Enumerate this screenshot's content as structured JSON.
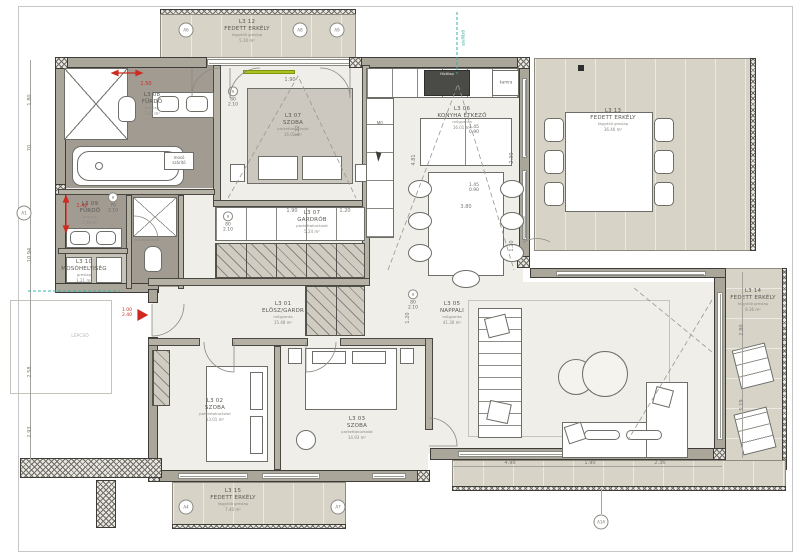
{
  "rooms": [
    {
      "code": "L3 01",
      "name": "ELŐSZ/GARDR",
      "material": "műgyanta",
      "area": "15.48 m²"
    },
    {
      "code": "L3 02",
      "name": "SZOBA",
      "material": "parkettaburkolat",
      "area": "13.01 m²"
    },
    {
      "code": "L3 03",
      "name": "SZOBA",
      "material": "parkettaburkolat",
      "area": "14.93 m²"
    },
    {
      "code": "L3 05",
      "name": "NAPPALI",
      "material": "műgyanta",
      "area": "41.30 m²"
    },
    {
      "code": "L3 06",
      "name": "KONYHA ÉTKEZŐ",
      "material": "műgyanta",
      "area": "16.01 m²"
    },
    {
      "code": "L3 07",
      "name": "SZOBA",
      "material": "parkettaburkolat",
      "area": "16.02 m²"
    },
    {
      "code": "L3 07",
      "name": "GARDRÓB",
      "material": "parkettaburkolat",
      "area": "5.24 m²"
    },
    {
      "code": "L3 08",
      "name": "FÜRDŐ",
      "material": "greslap",
      "area": "7.19 m²"
    },
    {
      "code": "L3 09",
      "name": "FÜRDŐ",
      "material": "greslap",
      "area": "5.68 m²"
    },
    {
      "code": "L3 10",
      "name": "MOSÓHELYISÉG",
      "material": "greslap",
      "area": "1.21 m²"
    },
    {
      "code": "L3 12",
      "name": "FEDETT ERKÉLY",
      "material": "fagyálló greslap",
      "area": "5.10 m²"
    },
    {
      "code": "L3 13",
      "name": "FEDETT ERKÉLY",
      "material": "fagyálló greslap",
      "area": "36.46 m²"
    },
    {
      "code": "L3 14",
      "name": "FEDETT ERKÉLY",
      "material": "fagyálló greslap",
      "area": "8.36 m²"
    },
    {
      "code": "L3 15",
      "name": "FEDETT ERKÉLY",
      "material": "fagyálló greslap",
      "area": "7.40 m²"
    }
  ],
  "dims": {
    "bath_w": "1.50",
    "bath2_w": "1.40",
    "bed7_w": "1.90",
    "bed7_h": "3.22",
    "gard_w": "1.90",
    "gard_d": "1.20",
    "kitchen_h": "4.81",
    "dining_w": "3.80",
    "kit_r1": "2.30",
    "kit_r2": "1.20",
    "hall_h": "1.20",
    "liv_b1": "4.98",
    "liv_b2": "1.90",
    "liv_b3": "2.36",
    "liv_r1": "2.80",
    "liv_r2": "5.19",
    "left1": "1.80",
    "left2": "70",
    "left3": "10.94",
    "left4": "2.58",
    "left5": "2.93"
  },
  "door_tag": {
    "w": "80",
    "h": "2.10",
    "letter": "a"
  },
  "door_tag_small": {
    "w": "70",
    "h": "2.10"
  },
  "entry_tag": {
    "w": "1.00",
    "h": "2.40"
  },
  "window_tag": {
    "a": "1.45",
    "b": "0.90"
  },
  "markers": {
    "m1": "A6",
    "m2": "A8",
    "m3": "A9",
    "m4": "A1",
    "m5": "A4",
    "m6": "A7",
    "m7": "A14"
  },
  "misc": {
    "mg": "MG",
    "kamra": "kamra",
    "fozolap": "főzőlap",
    "cab1": "mosó",
    "cab2": "szárító",
    "stair": "LÉPCSŐ",
    "vent": "szellőző"
  },
  "colors": {
    "accent_red": "#ce2a20",
    "accent_green": "#a9c41d",
    "accent_teal": "#35b0a8",
    "balcony_floor": "#d7d3c6",
    "room_floor": "#efeee8",
    "bath_floor": "#a19b92",
    "wall_fill": "#aba69a"
  }
}
